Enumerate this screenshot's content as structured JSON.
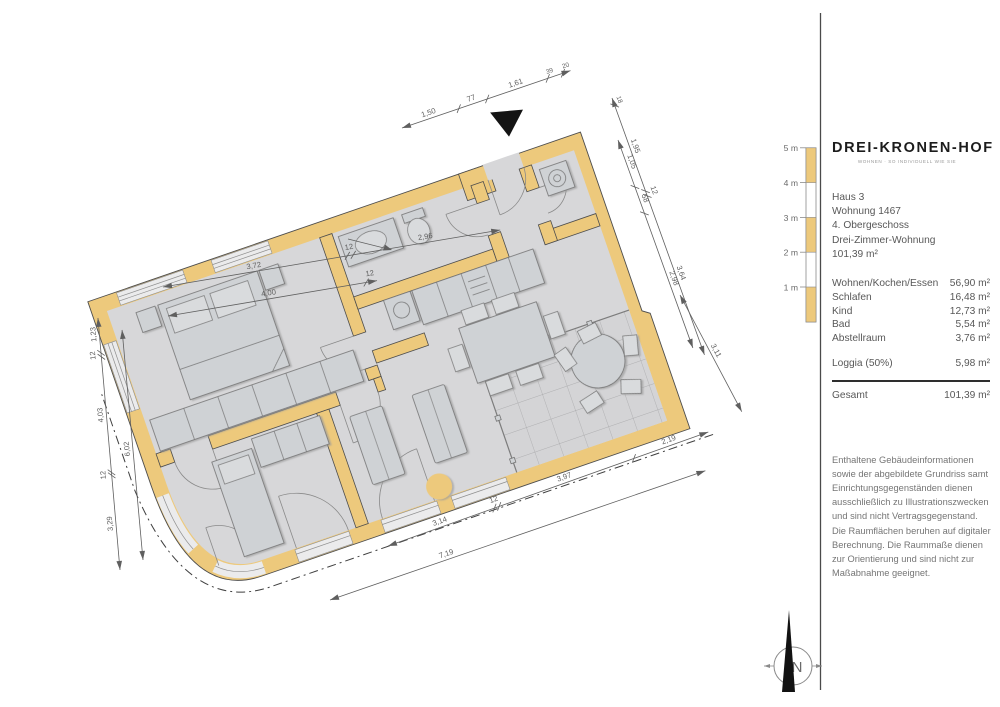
{
  "panel": {
    "brand": "DREI-KRONEN-HOF",
    "tagline": "WOHNEN · SO INDIVIDUELL WIE SIE",
    "info_lines": [
      "Haus 3",
      "Wohnung 1467",
      "4. Obergeschoss",
      "Drei-Zimmer-Wohnung",
      "101,39 m²"
    ],
    "rooms": [
      {
        "label": "Wohnen/Kochen/Essen",
        "area": "56,90 m²"
      },
      {
        "label": "Schlafen",
        "area": "16,48 m²"
      },
      {
        "label": "Kind",
        "area": "12,73 m²"
      },
      {
        "label": "Bad",
        "area": "5,54 m²"
      },
      {
        "label": "Abstellraum",
        "area": "3,76 m²"
      }
    ],
    "loggia": {
      "label": "Loggia (50%)",
      "area": "5,98 m²"
    },
    "total": {
      "label": "Gesamt",
      "area": "101,39 m²"
    },
    "disclaimer": "Enthaltene Gebäudeinformationen sowie der abgebildete Grundriss samt Einrichtungsgegenständen dienen ausschließlich zu Illustrationszwecken und sind nicht Vertragsgegenstand. Die Raumflächen beruhen auf digitaler Berechnung. Die Raummaße dienen zur Orientierung und sind nicht zur Maßabnahme geeignet.",
    "scale": {
      "labels": [
        "5 m",
        "4 m",
        "3 m",
        "2 m",
        "1 m"
      ]
    },
    "north_label": "N"
  },
  "plan": {
    "dimensions": {
      "top_left_outer": [
        "3,72",
        "12",
        "2,96"
      ],
      "top_left_inner": [
        "4,00",
        "12"
      ],
      "top_entrance": [
        "1,50",
        "77",
        "1,61",
        "39",
        "20"
      ],
      "right_outer": [
        "18",
        "1,95",
        "12",
        "3,64"
      ],
      "right_inner": [
        "1,05",
        "58",
        "2,98"
      ],
      "right_lower": [
        "3,11"
      ],
      "bottom_inner": [
        "3,14",
        "12",
        "3,97",
        "2,19"
      ],
      "bottom_outer": [
        "7,19"
      ],
      "left_outer": [
        "3,29",
        "12",
        "4,03",
        "12",
        "1,23"
      ],
      "left_inner": [
        "6,02"
      ]
    },
    "colors": {
      "wall": "#edc97c",
      "floor": "#d7d7d9",
      "furniture": "#cfd2d5"
    }
  }
}
